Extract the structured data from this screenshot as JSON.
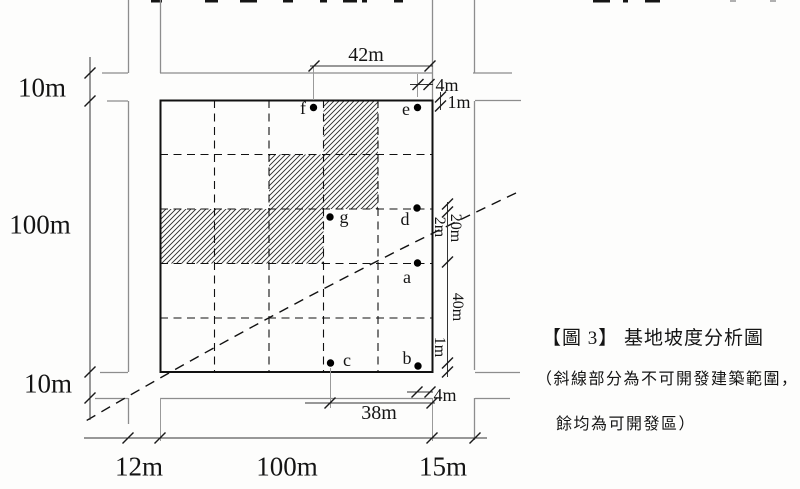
{
  "diagram": {
    "dims": {
      "left_top": "10m",
      "left_middle": "100m",
      "left_bottom": "10m",
      "bottom_left": "12m",
      "bottom_middle": "100m",
      "bottom_right": "15m",
      "top_width": "42m",
      "top_offset_e": "4m",
      "top_offset_e2": "1m",
      "right_offset_d": "2m",
      "right_d_to_a": "20m",
      "right_a_to_bottom": "40m",
      "right_offset_b": "1m",
      "bottom_width_c": "38m",
      "bottom_offset_b": "4m"
    },
    "points": {
      "a": "a",
      "b": "b",
      "c": "c",
      "d": "d",
      "e": "e",
      "f": "f",
      "g": "g"
    },
    "caption": {
      "title": "【圖 3】 基地坡度分析圖",
      "note_line1": "（斜線部分為不可開發建築範圍，",
      "note_line2": "餘均為可開發區）"
    }
  }
}
